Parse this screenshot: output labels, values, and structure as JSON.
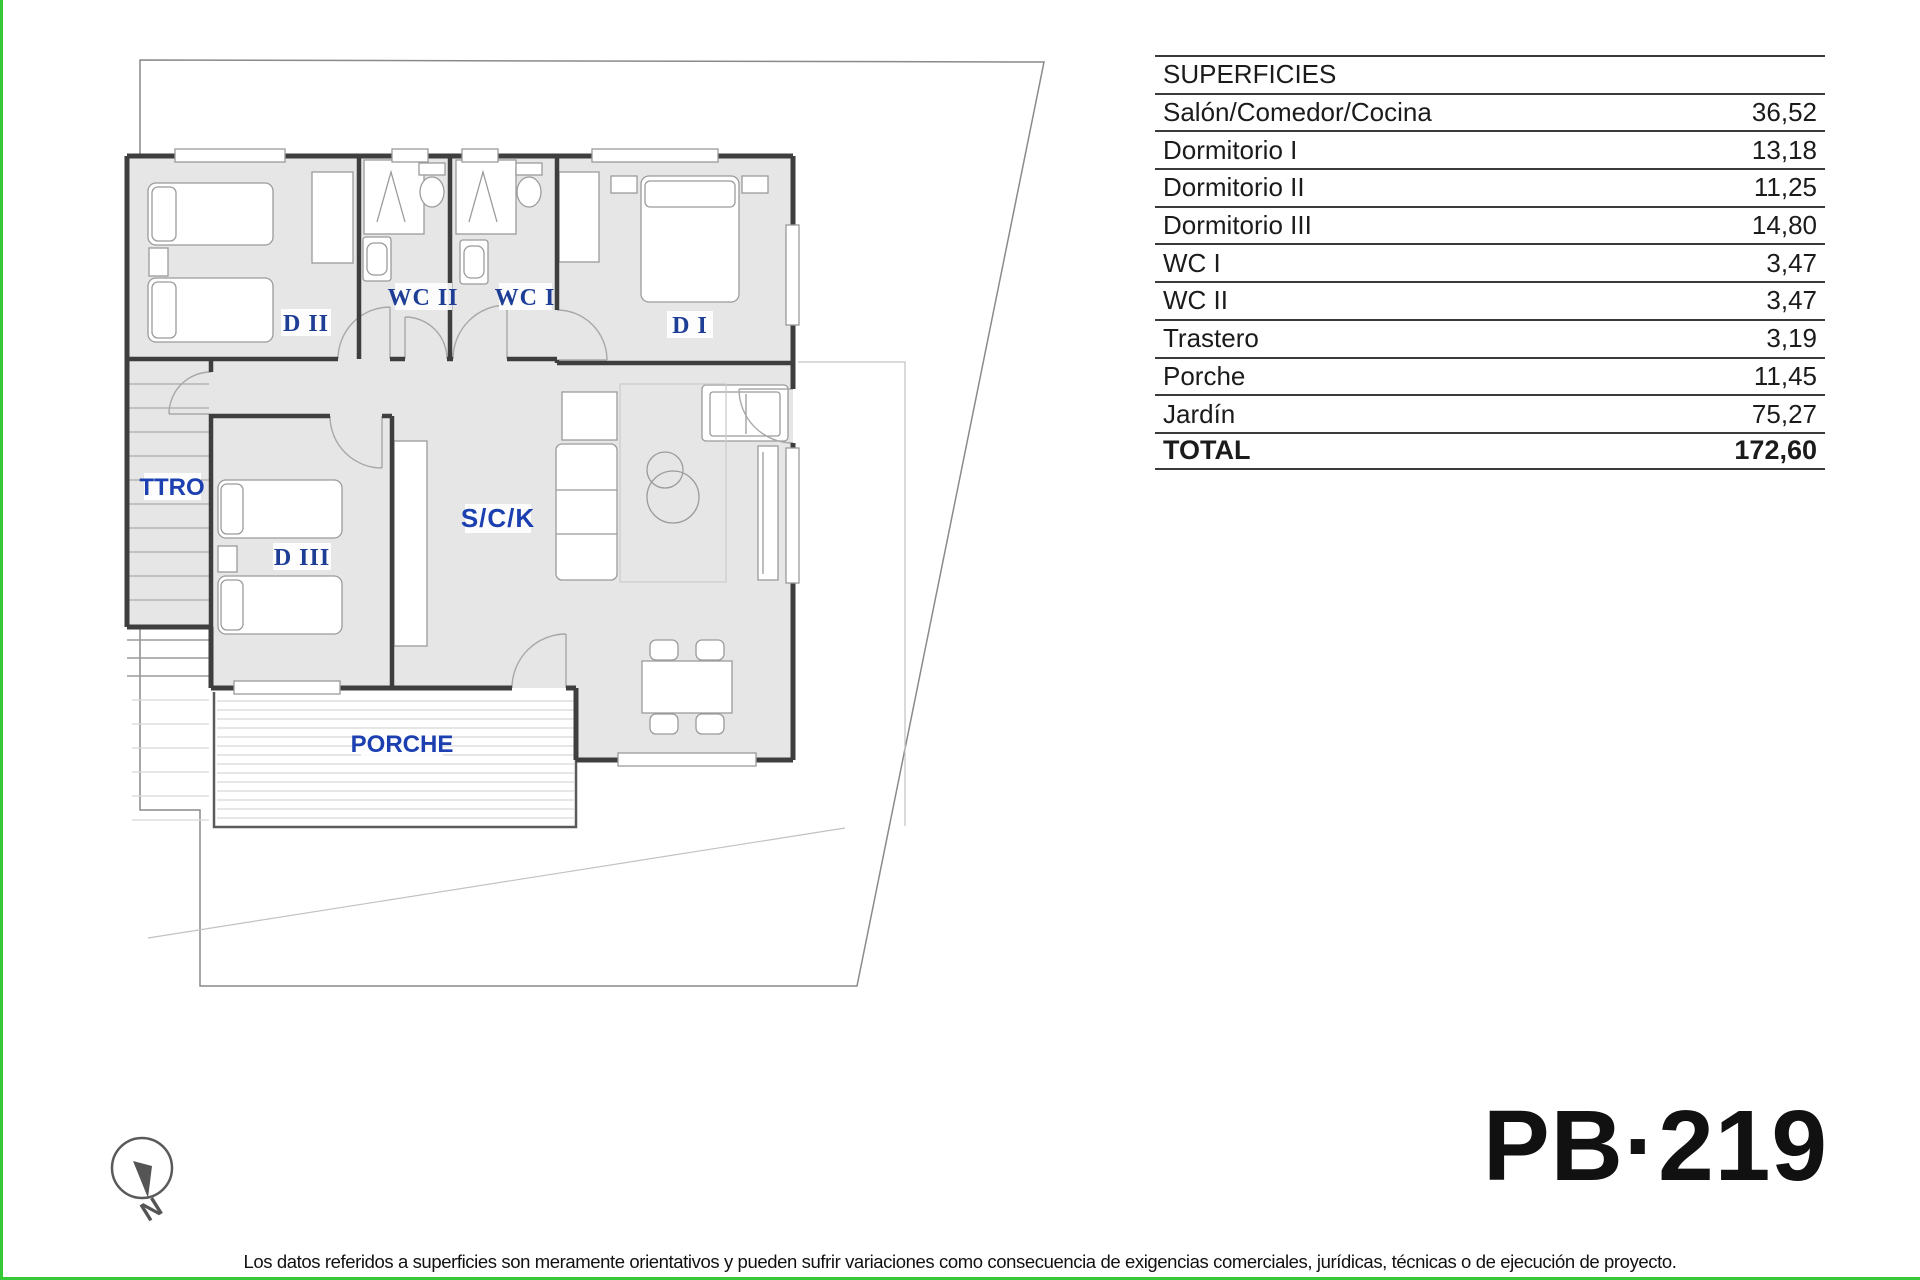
{
  "page": {
    "code": "PB·219",
    "footer": "Los datos referidos a superficies son meramente orientativos y pueden sufrir variaciones como consecuencia de exigencias comerciales, jurídicas, técnicas o de ejecución de proyecto."
  },
  "colors": {
    "accent_green": "#36c936",
    "room_label_blue": "#1e3e96",
    "plan_label_blue": "#1c40b0",
    "wall_gray": "#3e3e3e",
    "floor_gray": "#e6e6e6"
  },
  "compass": {
    "north_label": "N"
  },
  "table": {
    "header": "SUPERFICIES",
    "rows": [
      {
        "label": "Salón/Comedor/Cocina",
        "value": "36,52"
      },
      {
        "label": "Dormitorio I",
        "value": "13,18"
      },
      {
        "label": "Dormitorio II",
        "value": "11,25"
      },
      {
        "label": "Dormitorio III",
        "value": "14,80"
      },
      {
        "label": "WC I",
        "value": "3,47"
      },
      {
        "label": "WC II",
        "value": "3,47"
      },
      {
        "label": "Trastero",
        "value": "3,19"
      },
      {
        "label": "Porche",
        "value": "11,45"
      },
      {
        "label": "Jardín",
        "value": "75,27"
      }
    ],
    "total_label": "TOTAL",
    "total_value": "172,60"
  },
  "plan": {
    "rooms": [
      {
        "id": "d2",
        "label": "D II"
      },
      {
        "id": "wc2",
        "label": "WC II"
      },
      {
        "id": "wc1",
        "label": "WC I"
      },
      {
        "id": "d1",
        "label": "D I"
      },
      {
        "id": "ttro",
        "label": "TTRO"
      },
      {
        "id": "d3",
        "label": "D III"
      },
      {
        "id": "sck",
        "label": "S/C/K"
      },
      {
        "id": "porche",
        "label": "PORCHE"
      }
    ]
  }
}
